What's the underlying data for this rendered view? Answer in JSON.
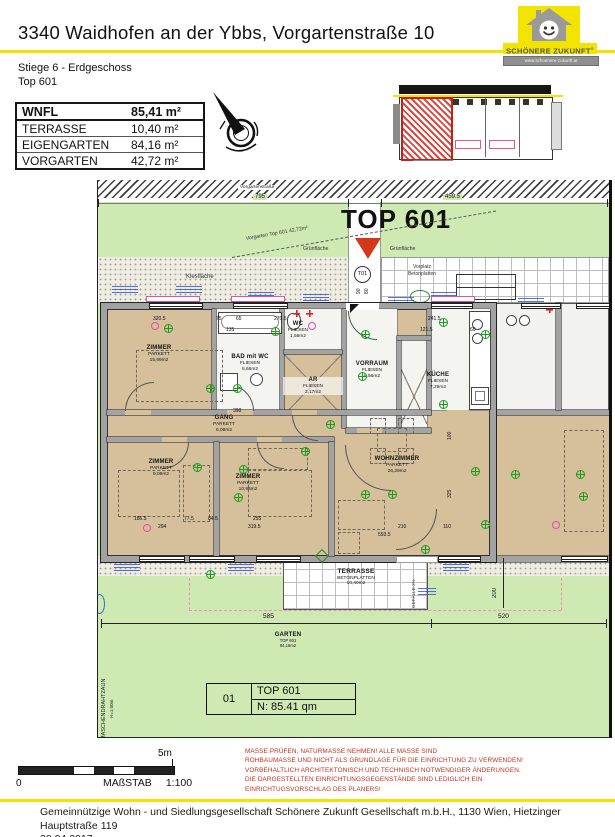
{
  "header": {
    "title": "3340 Waidhofen an der Ybbs, Vorgartenstraße 10",
    "logo": {
      "brand": "Schönere Zukunft",
      "reg": "®",
      "url": "www.schoenere-zukunft.at"
    }
  },
  "subheader": {
    "line1": "Stiege 6 - Erdgeschoss",
    "line2": "Top 601"
  },
  "area_table": {
    "rows": [
      {
        "label": "WNFL",
        "value": "85,41 m²"
      },
      {
        "label": "TERRASSE",
        "value": "10,40 m²"
      },
      {
        "label": "EIGENGARTEN",
        "value": "84,16 m²"
      },
      {
        "label": "VORGARTEN",
        "value": "42,72 m²"
      }
    ]
  },
  "plan": {
    "street_label": "Vorgartenstraße",
    "top_label": "TOP 601",
    "vorgarten_note": "Vorgarten Top 601  42,72m²",
    "gruen_left": "Grünfläche",
    "gruen_right": "Grünfläche",
    "kies_label": "Kiesfläche",
    "vorplatz_line1": "Vorplatz",
    "vorplatz_line2": "Betonplatten",
    "door_tag": "T01",
    "rooms": [
      {
        "name": "ZIMMER",
        "finish": "PARKETT",
        "area": "15,99m2"
      },
      {
        "name": "BAD mit WC",
        "finish": "FLIESEN",
        "area": "5,66m2"
      },
      {
        "name": "WC",
        "finish": "FLIESEN",
        "area": "1,56m2"
      },
      {
        "name": "AR",
        "finish": "FLIESEN",
        "area": "2,17m2"
      },
      {
        "name": "VORRAUM",
        "finish": "FLIESEN",
        "area": "6,56m2"
      },
      {
        "name": "KÜCHE",
        "finish": "FLIESEN",
        "area": "7,29m2"
      },
      {
        "name": "GANG",
        "finish": "PARKETT",
        "area": "6,08m2"
      },
      {
        "name": "ZIMMER",
        "finish": "PARKETT",
        "area": "9,08m2"
      },
      {
        "name": "ZIMMER",
        "finish": "PARKETT",
        "area": "10,96m2"
      },
      {
        "name": "WOHNZIMMER",
        "finish": "PARKETT",
        "area": "26,29m2"
      }
    ],
    "terrasse": {
      "name": "TERRASSE",
      "finish": "BETONPLATTEN",
      "area": "10,40m2"
    },
    "garten": {
      "name": "GARTEN",
      "sub": "TOP 601",
      "area": "84,16m2"
    },
    "gefaelle": "GEFÄLLE 2%",
    "fence_line1": "MASCHENDRAHTZAUN",
    "fence_line2": "H=1,00m",
    "dims": [
      "795",
      "459.5",
      "320.5",
      "75",
      "65",
      "270.5",
      "241.5",
      "121.5",
      "60",
      "135",
      "398",
      "186.5",
      "294",
      "77.5",
      "84.5",
      "255",
      "319.5",
      "210",
      "110",
      "593.5",
      "100",
      "325",
      "585",
      "520",
      "200",
      "90",
      "80"
    ],
    "unit_box": {
      "num": "01",
      "name": "TOP 601",
      "area": "N: 85.41 qm"
    }
  },
  "scalebar": {
    "zero": "0",
    "five": "5m",
    "label": "MAßSTAB",
    "ratio": "1:100"
  },
  "disclaimer": {
    "lines": [
      "MASSE PRÜFEN, NATURMASSE NEHMEN! ALLE MASSE SIND",
      "ROHBAUMASSE UND NICHT ALS GRUNDLAGE FÜR DIE EINRICHTUNG ZU VERWENDEN!",
      "VORBEHALTLICH ARCHITEKTONISCH UND TECHNISCH NOTWENDIGER ÄNDERUNGEN.",
      "DIE DARGESTELLTEN EINRICHTUNGSGEGENSTÄNDE SIND LEDIGLICH EIN",
      "EINRICHTUGSVORSCHLAG DES PLANERS!"
    ]
  },
  "footer": {
    "line1": "Gemeinnützige Wohn - und Siedlungsgesellschaft Schönere Zukunft Gesellschaft m.b.H., 1130 Wien, Hietzinger Hauptstraße 119",
    "date": "20.04.2017"
  },
  "colors": {
    "accent_yellow": "#f2e300",
    "grass_green": "#cfe9b2",
    "parquet_tan": "#d5c09b",
    "highlight_red": "#c5301f",
    "annotation_blue": "#2b4fd0",
    "symbol_green": "#1c9c1c",
    "symbol_magenta": "#e24fa0",
    "unit_marker_red": "#d2391b"
  }
}
